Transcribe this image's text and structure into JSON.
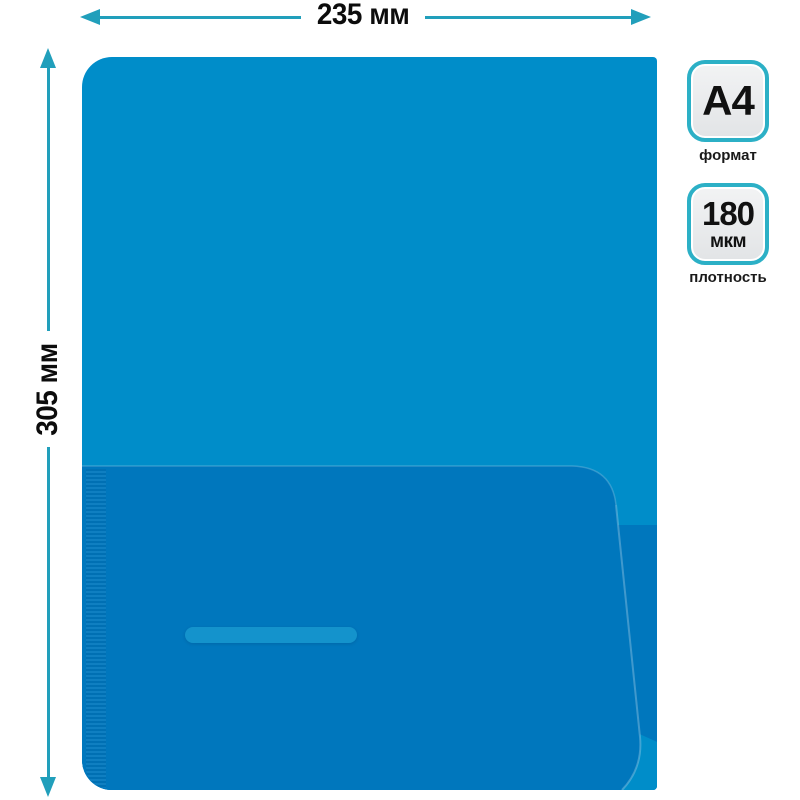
{
  "dimensions": {
    "width": {
      "label": "235 мм"
    },
    "height": {
      "label": "305 мм"
    }
  },
  "specs": {
    "format": {
      "value": "A4",
      "caption": "формат"
    },
    "density": {
      "value": "180",
      "unit": "мкм",
      "caption": "плотность"
    }
  },
  "colors": {
    "folder_body": "#008dc9",
    "folder_pocket": "#0077bd",
    "card_slot": "#1493cc",
    "dimension_arrow": "#219fbb",
    "badge_border": "#2cb0c6",
    "badge_fill": "#e9eaec",
    "label_text": "#0c0c0c"
  }
}
